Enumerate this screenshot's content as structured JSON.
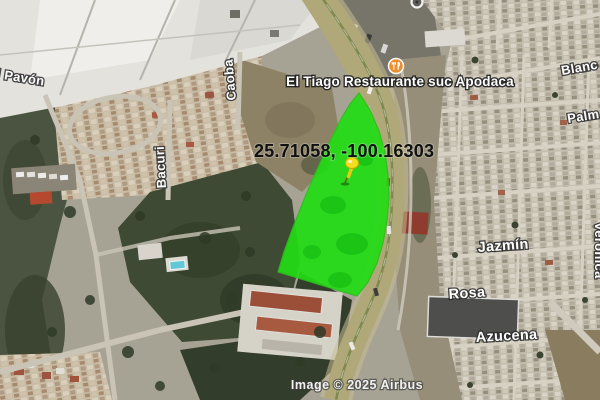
{
  "map": {
    "coordinates": "25.71058, -100.16303",
    "restaurant_poi": "El Tiago Restaurante suc Apodaca",
    "streets": {
      "pavon": "l Pavón",
      "bacuri": "Bacuri",
      "caoba": "Caoba",
      "blanca": "Blanc",
      "palma": "Palm",
      "jazmin": "Jazmín",
      "veronica": "Veronica",
      "rosa": "Rosa",
      "azucena": "Azucena"
    },
    "attribution": "Image © 2025 Airbus",
    "colors": {
      "parcel_green": "#22dd14",
      "pin_yellow": "#f4de1e",
      "poi_orange": "#ed8e2e",
      "road_yellow": "#b0a878"
    }
  }
}
